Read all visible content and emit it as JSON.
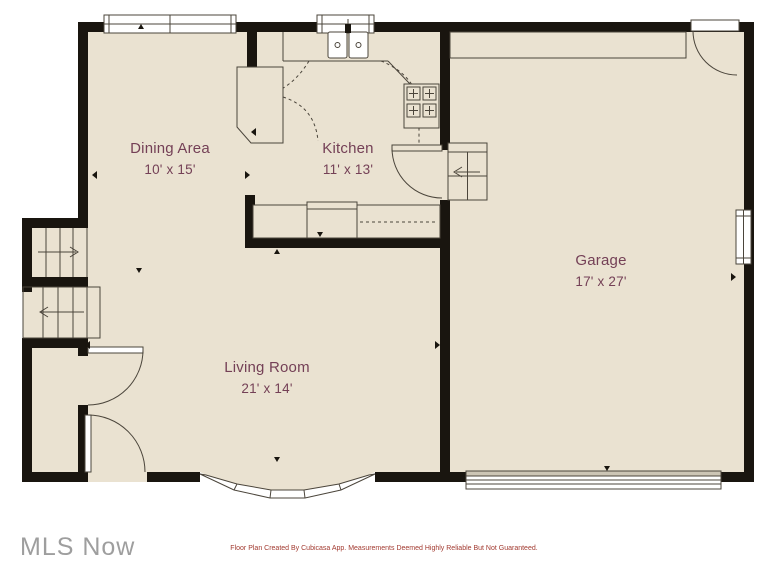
{
  "rooms": [
    {
      "name": "Dining Area",
      "dims": "10' x 15'"
    },
    {
      "name": "Kitchen",
      "dims": "11' x 13'"
    },
    {
      "name": "Garage",
      "dims": "17' x 27'"
    },
    {
      "name": "Living Room",
      "dims": "21' x 14'"
    }
  ],
  "footer": "Floor Plan Created By Cubicasa App. Measurements Deemed Highly Reliable But Not Guaranteed.",
  "watermark": "MLS Now",
  "colors": {
    "background": "#ffffff",
    "floor": "#eae2d1",
    "wall": "#19150f",
    "line": "#4b453b",
    "window_fill": "#ffffff",
    "garage_door_shade": "#ccc5b5",
    "room_label": "#744056",
    "footer_text": "#a23a30",
    "watermark_text": "#9e9e9e"
  }
}
